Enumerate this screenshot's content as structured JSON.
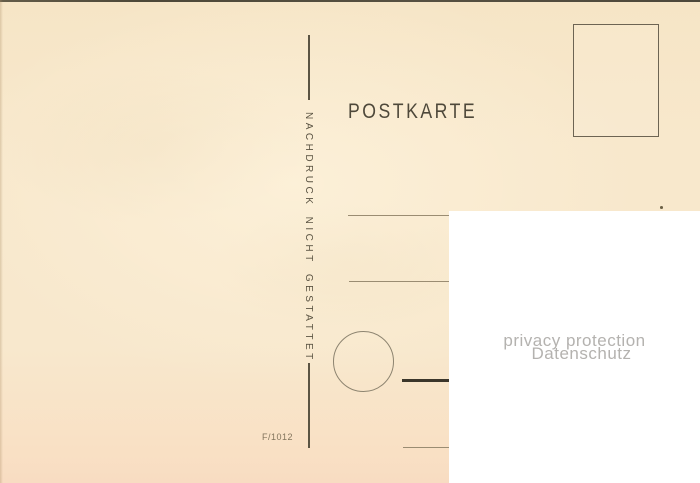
{
  "card": {
    "title": "POSTKARTE",
    "reprint_notice": "NACHDRUCK NICHT GESTATTET",
    "imprint_code": "F/1012"
  },
  "privacy_overlay": {
    "line1": "privacy protection",
    "line2": "Datenschutz"
  },
  "colors": {
    "paper": "#f8e8cc",
    "ink": "#4e483a",
    "divider": "#5b5443",
    "thin_line": "#9a8c72",
    "thick_line": "#3b362b",
    "stamp_border": "#6d6453",
    "overlay_bg": "#ffffff",
    "privacy_text": "#b4b2af"
  }
}
